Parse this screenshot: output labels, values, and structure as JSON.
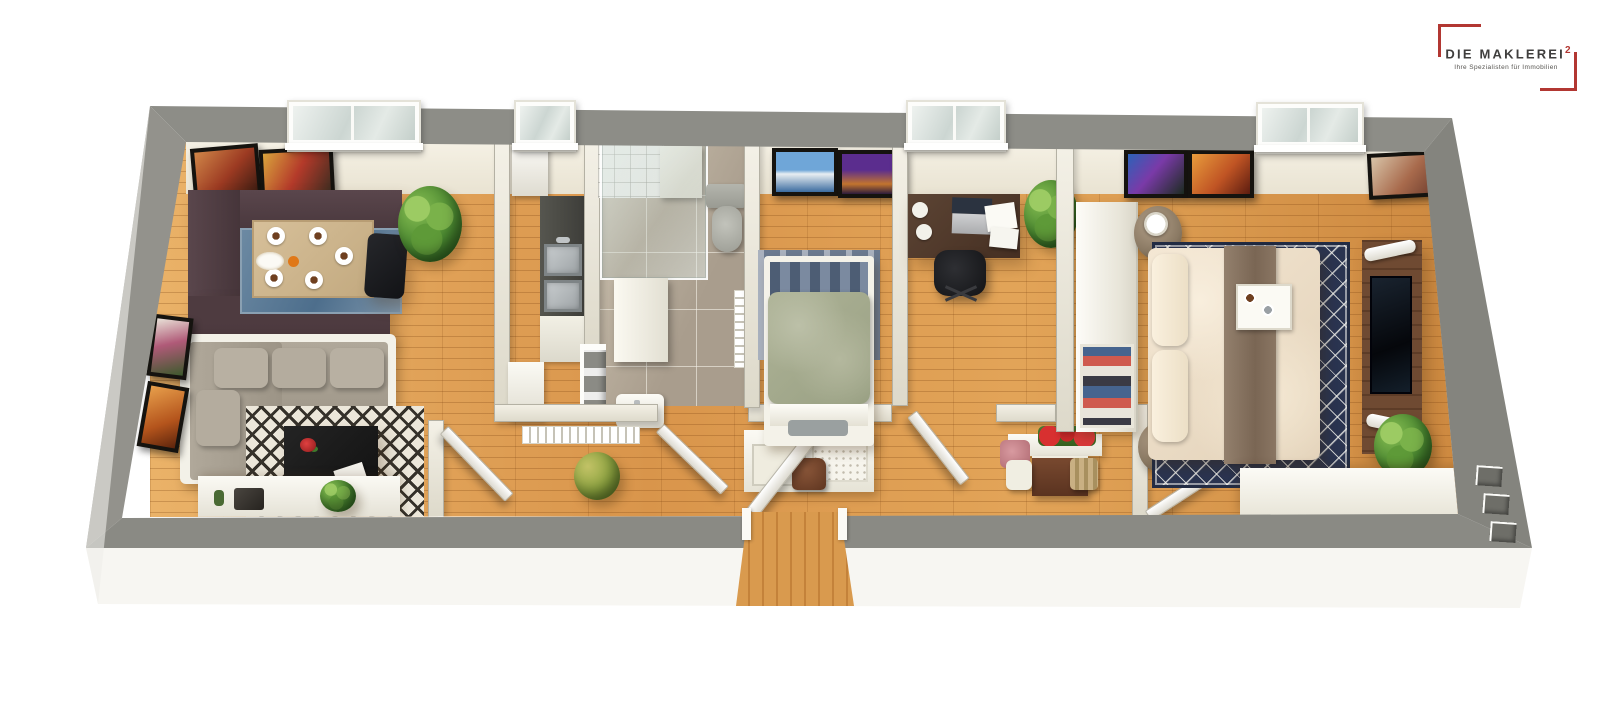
{
  "page": {
    "background": "#ffffff",
    "description": "3D rendered top-down floor plan of an elongated apartment"
  },
  "logo": {
    "brand": "DIE MAKLEREI",
    "superscript": "2",
    "tagline": "Ihre Spezialisten für Immobilien",
    "accent_color": "#b23732",
    "text_color": "#3f3e3d"
  },
  "floorplan": {
    "palette": {
      "outer_wall": "#8b8b85",
      "inner_wall": "#ece9dd",
      "wood_floor": "#e0a057",
      "tile_floor": "#b6ad9f",
      "bench_brown": "#4e3b40",
      "sofa_grey": "#a8a093",
      "duvet_cream": "#f1e4d0",
      "runner_brown": "#87725f",
      "rug_navy": "#2a3450",
      "rug_blue": "#5b7c98",
      "tv_wood": "#6f4a32"
    },
    "rooms": [
      {
        "id": "living-dining-room",
        "items": [
          "corner dining bench",
          "dining table with five place settings",
          "black dining chair",
          "blue rug",
          "two pictures on top wall",
          "two pictures on left wall",
          "window",
          "large potted plant",
          "grey corner sofa",
          "black coffee table with red flowers and magazine",
          "black-and-white diamond rug",
          "white sideboard with radio, bottle and plant"
        ]
      },
      {
        "id": "kitchen",
        "items": [
          "tall white cabinet",
          "dark worktop with double stainless-steel sink",
          "white worktop with dish rack",
          "white base cabinet",
          "stepped service duct"
        ]
      },
      {
        "id": "bathroom",
        "items": [
          "glass shower with tiled wall and seat",
          "window",
          "grey toilet",
          "washing machine",
          "towel radiator",
          "small washbasin",
          "grey tile floor"
        ]
      },
      {
        "id": "hallway",
        "items": [
          "entrance door with wooden threshold",
          "coat rack with hooks",
          "floor plant",
          "shoe console with carved panel, shelves and brown bag",
          "open doors to living room, bathroom, office and bedroom"
        ]
      },
      {
        "id": "kids-room",
        "items": [
          "two pictures on top wall",
          "single bed with sage-green blanket",
          "blue-grey rug at bed head",
          "white footboard with grey pad"
        ]
      },
      {
        "id": "home-office",
        "items": [
          "window",
          "dark wooden desk",
          "laptop",
          "papers",
          "two white plates",
          "black office chair",
          "potted plant",
          "flower console with red geraniums and pink cloth",
          "wooden drawer unit",
          "wicker basket",
          "small white stool"
        ]
      },
      {
        "id": "master-bedroom",
        "items": [
          "two pictures left of window",
          "window",
          "corner picture",
          "white wardrobe with open clothes shelf",
          "wicker bedside stool with lamp (top)",
          "wicker bedside stool with fruit bowl (bottom)",
          "double bed with cream duvet, two pillows and brown runner",
          "breakfast tray",
          "navy diamond rug",
          "dark wood TV panel with television and two white light bars",
          "potted plant",
          "white window bench"
        ]
      }
    ],
    "exterior": {
      "windows_on_top_wall": 4,
      "vents_bottom_right": 3,
      "entrance": "bottom centre with wooden threshold"
    }
  }
}
